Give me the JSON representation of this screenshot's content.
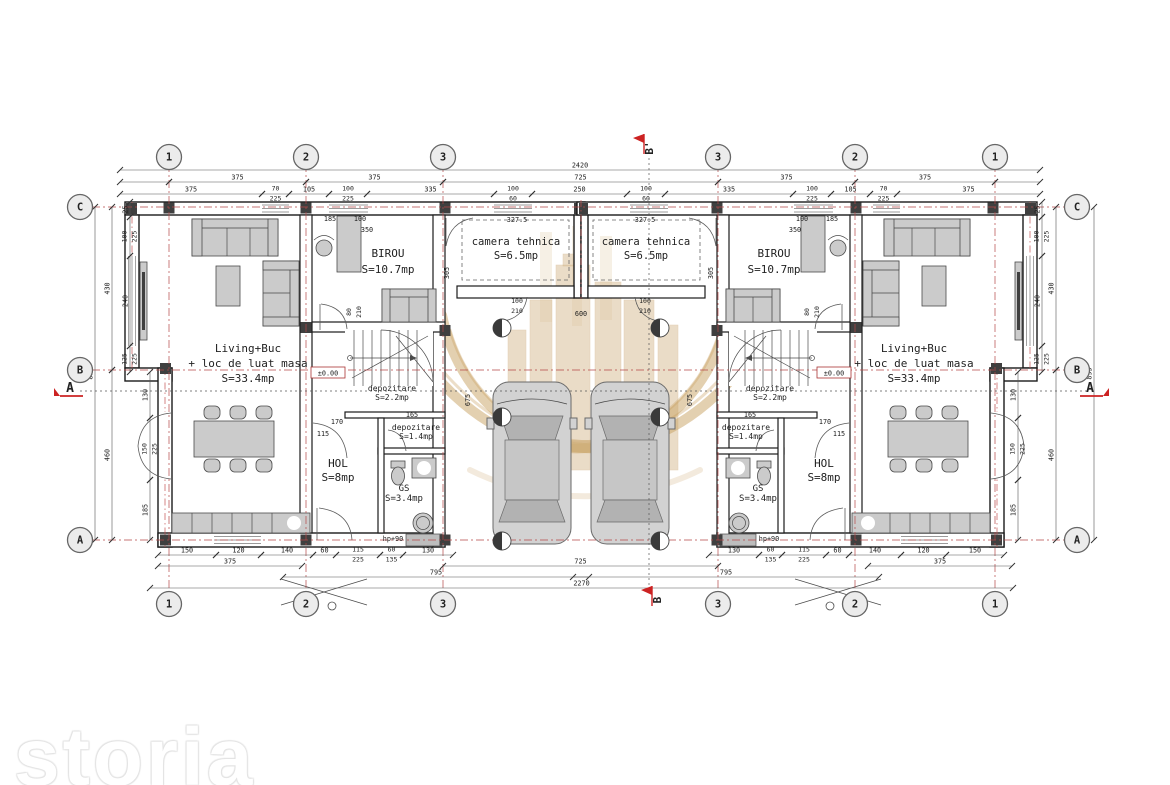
{
  "brand": {
    "watermark": "storia"
  },
  "drawing": {
    "grid_bubbles": {
      "top": {
        "y": 157,
        "items": [
          {
            "x": 169,
            "label": "1"
          },
          {
            "x": 306,
            "label": "2"
          },
          {
            "x": 443,
            "label": "3"
          },
          {
            "x": 718,
            "label": "3"
          },
          {
            "x": 855,
            "label": "2"
          },
          {
            "x": 995,
            "label": "1"
          }
        ]
      },
      "bottom": {
        "y": 604,
        "items": [
          {
            "x": 169,
            "label": "1"
          },
          {
            "x": 306,
            "label": "2"
          },
          {
            "x": 443,
            "label": "3"
          },
          {
            "x": 718,
            "label": "3"
          },
          {
            "x": 855,
            "label": "2"
          },
          {
            "x": 995,
            "label": "1"
          }
        ]
      },
      "left": {
        "x": 80,
        "items": [
          {
            "y": 207,
            "label": "C"
          },
          {
            "y": 370,
            "label": "B"
          },
          {
            "y": 540,
            "label": "A"
          }
        ]
      },
      "right": {
        "x": 1077,
        "items": [
          {
            "y": 207,
            "label": "C"
          },
          {
            "y": 370,
            "label": "B"
          },
          {
            "y": 540,
            "label": "A"
          }
        ]
      }
    },
    "section_markers": [
      {
        "id": "b-top",
        "x": 644,
        "y": 152,
        "label": "B'",
        "rot": -90
      },
      {
        "id": "b-bottom",
        "x": 652,
        "y": 604,
        "label": "B",
        "rot": -90
      },
      {
        "id": "a-left",
        "x": 70,
        "y": 392,
        "label": "A",
        "side": "left"
      },
      {
        "id": "a-right",
        "x": 1090,
        "y": 392,
        "label": "A",
        "side": "right"
      }
    ],
    "axes": {
      "vertical_x": [
        169,
        306,
        443,
        718,
        855,
        995
      ],
      "horizontal_y": [
        207,
        370,
        540
      ],
      "v_span": [
        148,
        616
      ],
      "h_span": [
        92,
        1080
      ],
      "color": "#b54848"
    },
    "section_lines": {
      "vertical_x": 649,
      "v_span": [
        158,
        592
      ],
      "horizontal_y": 391,
      "h_span": [
        80,
        1090
      ]
    },
    "rooms": [
      {
        "lines": [
          "Living+Buc",
          "+ loc de luat masa",
          "S=33.4mp"
        ],
        "x": 248,
        "y": 352,
        "fs": 11,
        "lh": 15
      },
      {
        "lines": [
          "BIROU",
          "S=10.7mp"
        ],
        "x": 388,
        "y": 257,
        "fs": 11,
        "lh": 16
      },
      {
        "lines": [
          "camera tehnica",
          "S=6.5mp"
        ],
        "x": 516,
        "y": 245,
        "fs": 10.5,
        "lh": 14
      },
      {
        "lines": [
          "depozitare",
          "S=2.2mp"
        ],
        "x": 392,
        "y": 391,
        "fs": 8,
        "lh": 9
      },
      {
        "lines": [
          "depozitare",
          "S=1.4mp"
        ],
        "x": 416,
        "y": 430,
        "fs": 8,
        "lh": 9
      },
      {
        "lines": [
          "HOL",
          "S=8mp"
        ],
        "x": 338,
        "y": 467,
        "fs": 11,
        "lh": 14
      },
      {
        "lines": [
          "GS",
          "S=3.4mp"
        ],
        "x": 404,
        "y": 491,
        "fs": 9,
        "lh": 10
      },
      {
        "lines": [
          "Living+Buc",
          "+ loc de luat masa",
          "S=33.4mp"
        ],
        "x": 914,
        "y": 352,
        "fs": 11,
        "lh": 15
      },
      {
        "lines": [
          "BIROU",
          "S=10.7mp"
        ],
        "x": 774,
        "y": 257,
        "fs": 11,
        "lh": 16
      },
      {
        "lines": [
          "camera tehnica",
          "S=6.5mp"
        ],
        "x": 646,
        "y": 245,
        "fs": 10.5,
        "lh": 14
      },
      {
        "lines": [
          "depozitare",
          "S=2.2mp"
        ],
        "x": 770,
        "y": 391,
        "fs": 8,
        "lh": 9
      },
      {
        "lines": [
          "depozitare",
          "S=1.4mp"
        ],
        "x": 746,
        "y": 430,
        "fs": 8,
        "lh": 9
      },
      {
        "lines": [
          "HOL",
          "S=8mp"
        ],
        "x": 824,
        "y": 467,
        "fs": 11,
        "lh": 14
      },
      {
        "lines": [
          "GS",
          "S=3.4mp"
        ],
        "x": 758,
        "y": 491,
        "fs": 9,
        "lh": 10
      }
    ],
    "levels": [
      {
        "x": 328,
        "y": 374,
        "text": "±0.00"
      },
      {
        "x": 834,
        "y": 374,
        "text": "±0.00"
      }
    ],
    "dims": {
      "h_rows": [
        {
          "y": 170,
          "segs": [
            [
              120,
              1040,
              "2420"
            ]
          ]
        },
        {
          "y": 182,
          "segs": [
            [
              120,
              169,
              ""
            ],
            [
              169,
              306,
              "375"
            ],
            [
              306,
              443,
              "375"
            ],
            [
              443,
              718,
              "725"
            ],
            [
              718,
              855,
              "375"
            ],
            [
              855,
              995,
              "375"
            ],
            [
              995,
              1040,
              ""
            ]
          ]
        },
        {
          "y": 194,
          "segs": [
            [
              120,
              262,
              "375"
            ],
            [
              262,
              289,
              "70|225"
            ],
            [
              289,
              329,
              "105"
            ],
            [
              329,
              367,
              "100|225"
            ],
            [
              367,
              494,
              "335"
            ],
            [
              494,
              532,
              "100|60"
            ],
            [
              532,
              627,
              "250"
            ],
            [
              627,
              665,
              "100|60"
            ],
            [
              665,
              793,
              "335"
            ],
            [
              793,
              831,
              "100|225"
            ],
            [
              831,
              870,
              "105"
            ],
            [
              870,
              897,
              "70|225"
            ],
            [
              897,
              1040,
              "375"
            ]
          ]
        },
        {
          "y": 555,
          "segs": [
            [
              158,
              216,
              "150"
            ],
            [
              216,
              261,
              "120"
            ],
            [
              261,
              313,
              "140"
            ],
            [
              313,
              336,
              "60"
            ],
            [
              336,
              380,
              "115|225"
            ],
            [
              380,
              403,
              "60|135"
            ],
            [
              403,
              453,
              "130"
            ],
            [
              709,
              759,
              "130"
            ],
            [
              759,
              782,
              "60|135"
            ],
            [
              782,
              826,
              "115|225"
            ],
            [
              826,
              849,
              "60"
            ],
            [
              849,
              901,
              "140"
            ],
            [
              901,
              946,
              "120"
            ],
            [
              946,
              1004,
              "150"
            ]
          ]
        },
        {
          "y": 566,
          "segs": [
            [
              158,
              302,
              "375"
            ],
            [
              443,
              718,
              "725"
            ],
            [
              868,
              1012,
              "375"
            ]
          ]
        },
        {
          "y": 577,
          "segs": [
            [
              283,
              589,
              "795"
            ],
            [
              573,
              879,
              "795"
            ]
          ]
        },
        {
          "y": 588,
          "segs": [
            [
              150,
              1013,
              "2270"
            ]
          ]
        }
      ],
      "v_cols": [
        {
          "x": 95,
          "segs": [
            [
              207,
              540,
              "895"
            ]
          ]
        },
        {
          "x": 112,
          "segs": [
            [
              207,
              370,
              "430"
            ],
            [
              370,
              540,
              "460"
            ]
          ]
        },
        {
          "x": 130,
          "segs": [
            [
              202,
              217,
              "25"
            ],
            [
              217,
              256,
              "100|225"
            ],
            [
              256,
              346,
              "240"
            ],
            [
              346,
              372,
              "125|225"
            ]
          ]
        },
        {
          "x": 150,
          "segs": [
            [
              372,
              418,
              "130"
            ],
            [
              418,
              480,
              "150|225"
            ],
            [
              480,
              540,
              "185"
            ]
          ]
        },
        {
          "x": 1094,
          "segs": [
            [
              207,
              540,
              "895"
            ]
          ]
        },
        {
          "x": 1056,
          "segs": [
            [
              207,
              370,
              "430"
            ],
            [
              370,
              540,
              "460"
            ]
          ]
        },
        {
          "x": 1042,
          "segs": [
            [
              202,
              217,
              "25"
            ],
            [
              217,
              256,
              "100|225"
            ],
            [
              256,
              346,
              "240"
            ],
            [
              346,
              372,
              "125|225"
            ]
          ]
        },
        {
          "x": 1018,
          "segs": [
            [
              372,
              418,
              "130"
            ],
            [
              418,
              480,
              "150|225"
            ],
            [
              480,
              540,
              "185"
            ]
          ]
        }
      ],
      "floating": [
        [
          "327.5",
          517,
          222,
          0
        ],
        [
          "327.5",
          645,
          222,
          0
        ],
        [
          "305",
          449,
          273,
          90
        ],
        [
          "305",
          713,
          273,
          90
        ],
        [
          "350",
          367,
          232,
          0
        ],
        [
          "350",
          795,
          232,
          0
        ],
        [
          "185",
          330,
          221,
          0
        ],
        [
          "185",
          832,
          221,
          0
        ],
        [
          "100",
          360,
          221,
          0
        ],
        [
          "100",
          802,
          221,
          0
        ],
        [
          "80|210",
          352,
          312,
          90
        ],
        [
          "80|210",
          810,
          312,
          90
        ],
        [
          "100|210",
          517,
          304,
          0
        ],
        [
          "100|210",
          645,
          304,
          0
        ],
        [
          "600",
          581,
          316,
          0
        ],
        [
          "675",
          470,
          400,
          90
        ],
        [
          "675",
          692,
          400,
          90
        ],
        [
          "170",
          337,
          424,
          0
        ],
        [
          "170",
          825,
          424,
          0
        ],
        [
          "115",
          323,
          436,
          0
        ],
        [
          "115",
          839,
          436,
          0
        ],
        [
          "165",
          412,
          417,
          0
        ],
        [
          "165",
          750,
          417,
          0
        ],
        [
          "hp+90",
          393,
          541,
          0
        ],
        [
          "hp+90",
          769,
          541,
          0
        ]
      ]
    },
    "symbols": {
      "level_circles": [
        [
          502,
          328
        ],
        [
          660,
          328
        ],
        [
          502,
          417
        ],
        [
          660,
          417
        ],
        [
          502,
          541
        ],
        [
          660,
          541
        ]
      ],
      "porch_dots": [
        [
          332,
          606
        ],
        [
          830,
          606
        ]
      ]
    }
  }
}
